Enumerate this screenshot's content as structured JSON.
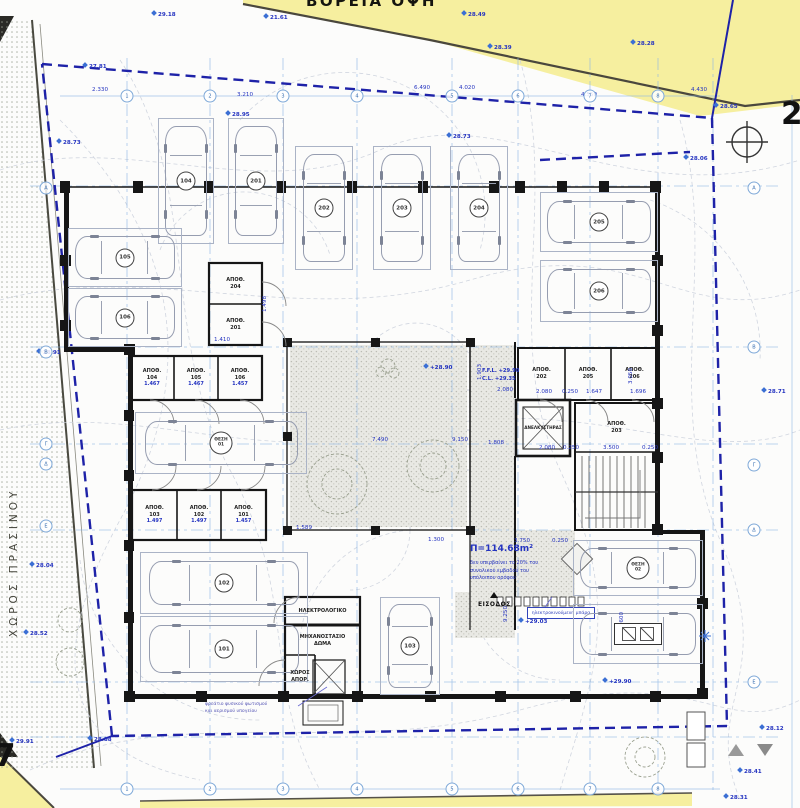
{
  "header": {
    "street_label": "ΒΟΡΕΙΑ ΟΨΗ"
  },
  "sheets": {
    "right": "2",
    "left": "7"
  },
  "left_strip": {
    "label": "ΧΩΡΟΣ ΠΡΑΣΙΝΟΥ"
  },
  "area_note": {
    "area": "Π=114.68m²",
    "lines": [
      "δεν υπερβαίνει το 20% του",
      "συνολικού εμβαδού του",
      "υπόλοιπου ορόφου"
    ]
  },
  "entrance": {
    "label": "ΕΙΣΟΔΟΣ",
    "barrier_label": "ηλεκτροκινούμενη μπάρα"
  },
  "levels": {
    "ffl": "F.F.L. +29.90",
    "cl": "C.L. +29.35"
  },
  "shaft_note": {
    "lines": [
      "φρεάτιο φυσικού φωτισμού",
      "και αερισμού υπογείου"
    ]
  },
  "colors": {
    "boundary": "#1e22a8",
    "grid": "#85b6e4",
    "dim_text": "#2433c0",
    "street_fill": "#f6ef9f",
    "wall": "#161616"
  },
  "rooms": [
    {
      "x": 209,
      "y": 264,
      "w": 53,
      "h": 40,
      "lines": [
        "ΑΠΟΘ.",
        "204"
      ]
    },
    {
      "x": 209,
      "y": 306,
      "w": 53,
      "h": 38,
      "lines": [
        "ΑΠΟΘ.",
        "201"
      ]
    },
    {
      "x": 130,
      "y": 356,
      "w": 44,
      "h": 44,
      "lines": [
        "ΑΠΟΘ.",
        "104"
      ],
      "dim": "1.467"
    },
    {
      "x": 174,
      "y": 356,
      "w": 44,
      "h": 44,
      "lines": [
        "ΑΠΟΘ.",
        "105"
      ],
      "dim": "1.467"
    },
    {
      "x": 218,
      "y": 356,
      "w": 44,
      "h": 44,
      "lines": [
        "ΑΠΟΘ.",
        "106"
      ],
      "dim": "1.457"
    },
    {
      "x": 132,
      "y": 490,
      "w": 45,
      "h": 50,
      "lines": [
        "ΑΠΟΘ.",
        "103"
      ],
      "dim": "1.497"
    },
    {
      "x": 177,
      "y": 490,
      "w": 44,
      "h": 50,
      "lines": [
        "ΑΠΟΘ.",
        "102"
      ],
      "dim": "1.497"
    },
    {
      "x": 221,
      "y": 490,
      "w": 45,
      "h": 50,
      "lines": [
        "ΑΠΟΘ.",
        "101"
      ],
      "dim": "1.457"
    },
    {
      "x": 518,
      "y": 348,
      "w": 47,
      "h": 52,
      "lines": [
        "ΑΠΟΘ.",
        "202"
      ]
    },
    {
      "x": 565,
      "y": 348,
      "w": 46,
      "h": 52,
      "lines": [
        "ΑΠΟΘ.",
        "205"
      ]
    },
    {
      "x": 611,
      "y": 348,
      "w": 47,
      "h": 52,
      "lines": [
        "ΑΠΟΘ.",
        "206"
      ]
    },
    {
      "x": 575,
      "y": 403,
      "w": 83,
      "h": 49,
      "lines": [
        "ΑΠΟΘ.",
        "203"
      ]
    },
    {
      "x": 516,
      "y": 400,
      "w": 54,
      "h": 56,
      "lines": [
        "ΑΝΕΛΚΥΣΤΗΡΑΣ"
      ],
      "cls": "lift"
    },
    {
      "x": 287,
      "y": 599,
      "w": 71,
      "h": 24,
      "lines": [
        "ΗΛΕΚΤΡΟΛΟΓΙΚΟ"
      ]
    },
    {
      "x": 287,
      "y": 627,
      "w": 71,
      "h": 28,
      "lines": [
        "ΜΗΧΑΝΟΣΤΑΣΙΟ",
        "ΔΩΜΑ"
      ]
    },
    {
      "x": 286,
      "y": 658,
      "w": 28,
      "h": 38,
      "lines": [
        "ΧΩΡΟΣ",
        "ΑΠΟΡ."
      ]
    }
  ],
  "stalls": [
    {
      "x": 158,
      "y": 118,
      "w": 54,
      "h": 124,
      "dir": "v",
      "label": "104"
    },
    {
      "x": 228,
      "y": 118,
      "w": 54,
      "h": 124,
      "dir": "v",
      "label": "201"
    },
    {
      "x": 295,
      "y": 146,
      "w": 56,
      "h": 122,
      "dir": "v",
      "label": "202"
    },
    {
      "x": 373,
      "y": 146,
      "w": 56,
      "h": 122,
      "dir": "v",
      "label": "203"
    },
    {
      "x": 450,
      "y": 146,
      "w": 56,
      "h": 122,
      "dir": "v",
      "label": "204"
    },
    {
      "x": 540,
      "y": 192,
      "w": 116,
      "h": 58,
      "dir": "h",
      "label": "205"
    },
    {
      "x": 540,
      "y": 260,
      "w": 116,
      "h": 60,
      "dir": "h",
      "label": "206"
    },
    {
      "x": 68,
      "y": 228,
      "w": 112,
      "h": 57,
      "dir": "h",
      "label": "105"
    },
    {
      "x": 68,
      "y": 288,
      "w": 112,
      "h": 57,
      "dir": "h",
      "label": "106"
    },
    {
      "x": 135,
      "y": 412,
      "w": 170,
      "h": 60,
      "dir": "h",
      "label": "ΘΕΣΗ",
      "sub": "01"
    },
    {
      "x": 140,
      "y": 552,
      "w": 166,
      "h": 60,
      "dir": "h",
      "label": "102"
    },
    {
      "x": 140,
      "y": 616,
      "w": 166,
      "h": 64,
      "dir": "h",
      "label": "101"
    },
    {
      "x": 380,
      "y": 597,
      "w": 58,
      "h": 96,
      "dir": "v",
      "label": "103"
    },
    {
      "x": 573,
      "y": 540,
      "w": 128,
      "h": 54,
      "dir": "h",
      "label": "ΘΕΣΗ",
      "sub": "02"
    },
    {
      "x": 573,
      "y": 604,
      "w": 128,
      "h": 58,
      "dir": "h",
      "label": "",
      "badge": true
    }
  ],
  "spots": [
    {
      "x": 152,
      "y": 11,
      "t": "29.18"
    },
    {
      "x": 264,
      "y": 14,
      "t": "21.61"
    },
    {
      "x": 83,
      "y": 63,
      "t": "27.81"
    },
    {
      "x": 462,
      "y": 11,
      "t": "28.49"
    },
    {
      "x": 488,
      "y": 44,
      "t": "28.39"
    },
    {
      "x": 631,
      "y": 40,
      "t": "28.28"
    },
    {
      "x": 226,
      "y": 111,
      "t": "28.95"
    },
    {
      "x": 447,
      "y": 133,
      "t": "28.73"
    },
    {
      "x": 714,
      "y": 103,
      "t": "28.65"
    },
    {
      "x": 57,
      "y": 139,
      "t": "28.73"
    },
    {
      "x": 684,
      "y": 155,
      "t": "28.06"
    },
    {
      "x": 762,
      "y": 388,
      "t": "28.71"
    },
    {
      "x": 37,
      "y": 349,
      "t": "28.91"
    },
    {
      "x": 30,
      "y": 562,
      "t": "28.04"
    },
    {
      "x": 24,
      "y": 630,
      "t": "28.52"
    },
    {
      "x": 424,
      "y": 364,
      "t": "+28.90"
    },
    {
      "x": 519,
      "y": 618,
      "t": "+29.03"
    },
    {
      "x": 88,
      "y": 736,
      "t": "28.88"
    },
    {
      "x": 10,
      "y": 738,
      "t": "29.91"
    },
    {
      "x": 760,
      "y": 725,
      "t": "28.12"
    },
    {
      "x": 738,
      "y": 768,
      "t": "28.41"
    },
    {
      "x": 724,
      "y": 794,
      "t": "28.31"
    },
    {
      "x": 603,
      "y": 678,
      "t": "+29.90"
    }
  ],
  "dims": [
    {
      "x": 92,
      "y": 87,
      "t": "2.330"
    },
    {
      "x": 237,
      "y": 92,
      "t": "3.210"
    },
    {
      "x": 414,
      "y": 85,
      "t": "6.490"
    },
    {
      "x": 459,
      "y": 85,
      "t": "4.020"
    },
    {
      "x": 581,
      "y": 92,
      "t": "4.550"
    },
    {
      "x": 691,
      "y": 87,
      "t": "4.430"
    },
    {
      "x": 214,
      "y": 337,
      "t": "1.410"
    },
    {
      "x": 262,
      "y": 312,
      "t": "1.498",
      "r": 1
    },
    {
      "x": 296,
      "y": 525,
      "t": "1.589"
    },
    {
      "x": 372,
      "y": 437,
      "t": "7.490"
    },
    {
      "x": 452,
      "y": 437,
      "t": "9.150"
    },
    {
      "x": 477,
      "y": 380,
      "t": "1.903",
      "r": 1
    },
    {
      "x": 497,
      "y": 387,
      "t": "2.080"
    },
    {
      "x": 536,
      "y": 389,
      "t": "2.080"
    },
    {
      "x": 562,
      "y": 389,
      "t": "0.250"
    },
    {
      "x": 586,
      "y": 389,
      "t": "1.647"
    },
    {
      "x": 630,
      "y": 389,
      "t": "1.696"
    },
    {
      "x": 628,
      "y": 384,
      "t": "3.050",
      "r": 1
    },
    {
      "x": 488,
      "y": 440,
      "t": "1.808"
    },
    {
      "x": 539,
      "y": 445,
      "t": "2.080"
    },
    {
      "x": 563,
      "y": 445,
      "t": "0.250"
    },
    {
      "x": 603,
      "y": 445,
      "t": "3.500"
    },
    {
      "x": 642,
      "y": 445,
      "t": "0.250"
    },
    {
      "x": 514,
      "y": 538,
      "t": "3.750"
    },
    {
      "x": 552,
      "y": 538,
      "t": "0.250"
    },
    {
      "x": 619,
      "y": 628,
      "t": "9.600",
      "r": 1
    },
    {
      "x": 503,
      "y": 622,
      "t": "9.250",
      "r": 1
    },
    {
      "x": 428,
      "y": 537,
      "t": "1.300"
    }
  ],
  "grid": {
    "top": [
      {
        "x": 127,
        "l": "1"
      },
      {
        "x": 210,
        "l": "2"
      },
      {
        "x": 283,
        "l": "3"
      },
      {
        "x": 357,
        "l": "4"
      },
      {
        "x": 452,
        "l": "5"
      },
      {
        "x": 518,
        "l": "6"
      },
      {
        "x": 590,
        "l": "7"
      },
      {
        "x": 658,
        "l": "8"
      }
    ],
    "bottom": [
      {
        "x": 127,
        "l": "1"
      },
      {
        "x": 210,
        "l": "2"
      },
      {
        "x": 283,
        "l": "3"
      },
      {
        "x": 357,
        "l": "4"
      },
      {
        "x": 452,
        "l": "5"
      },
      {
        "x": 518,
        "l": "6"
      },
      {
        "x": 590,
        "l": "7"
      },
      {
        "x": 658,
        "l": "8"
      }
    ],
    "left": [
      {
        "y": 188,
        "l": "Α"
      },
      {
        "y": 352,
        "l": "Β"
      },
      {
        "y": 444,
        "l": "Γ"
      },
      {
        "y": 464,
        "l": "Δ"
      },
      {
        "y": 526,
        "l": "Ε"
      }
    ],
    "right": [
      {
        "y": 188,
        "l": "Α"
      },
      {
        "y": 347,
        "l": "Β"
      },
      {
        "y": 465,
        "l": "Γ"
      },
      {
        "y": 530,
        "l": "Δ"
      },
      {
        "y": 682,
        "l": "Ε"
      }
    ]
  }
}
